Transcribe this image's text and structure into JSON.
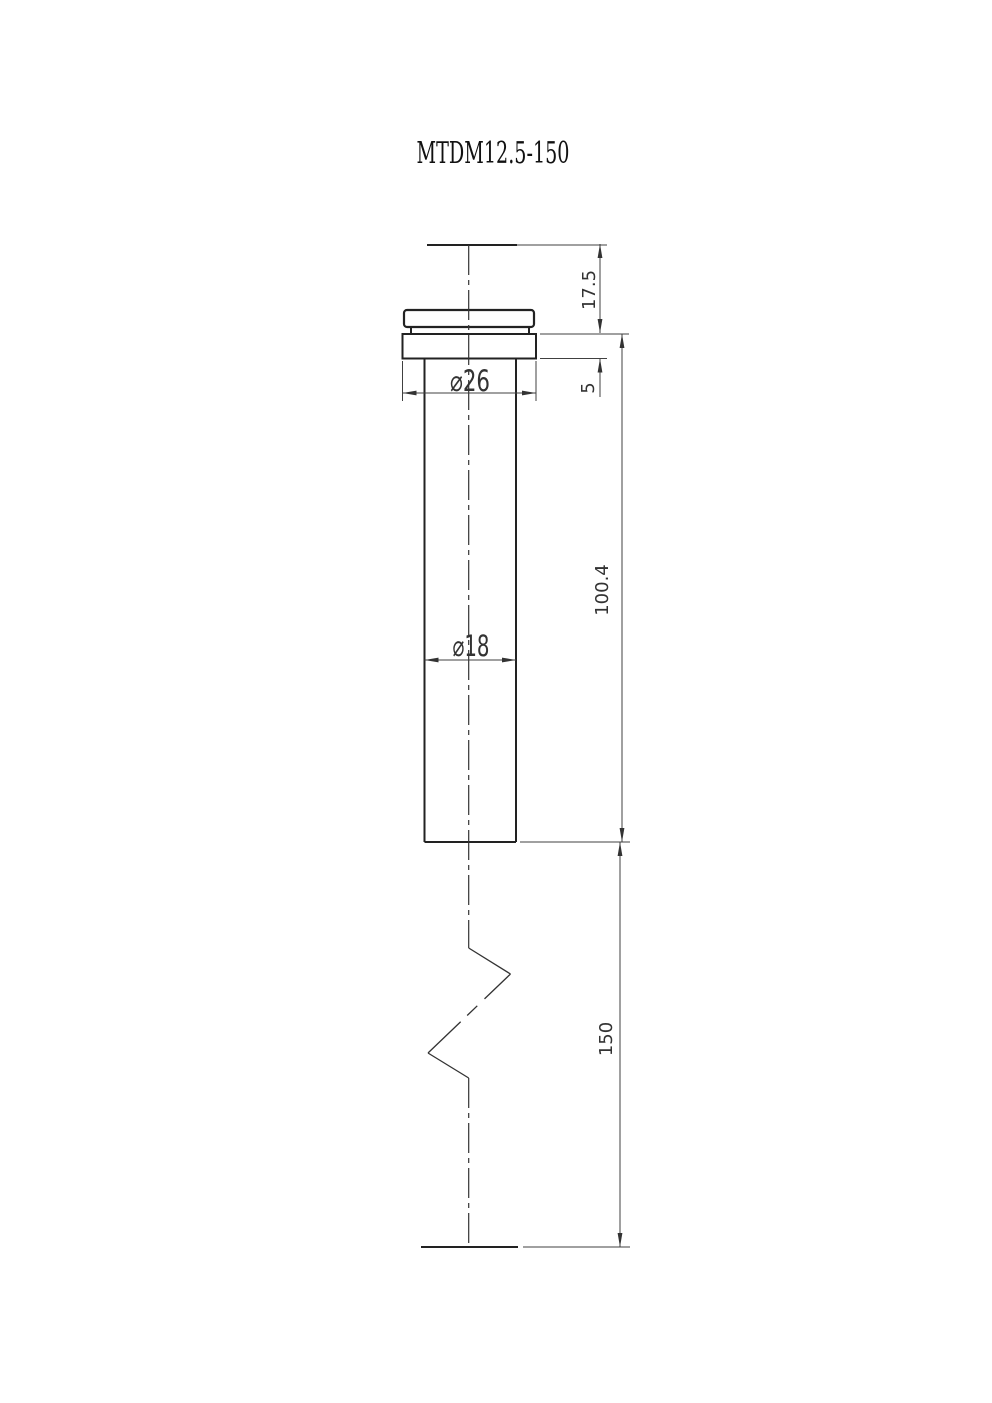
{
  "title": "MTDM12.5-150",
  "dimensions": {
    "top_to_flange": "17.5",
    "flange_thickness": "5",
    "flange_diameter": "⌀26",
    "shaft_diameter": "⌀18",
    "upper_length": "100.4",
    "lower_length": "150"
  },
  "colors": {
    "object_line": "#222222",
    "dimension_line": "#404040",
    "text": "#333333",
    "background": "#ffffff"
  }
}
